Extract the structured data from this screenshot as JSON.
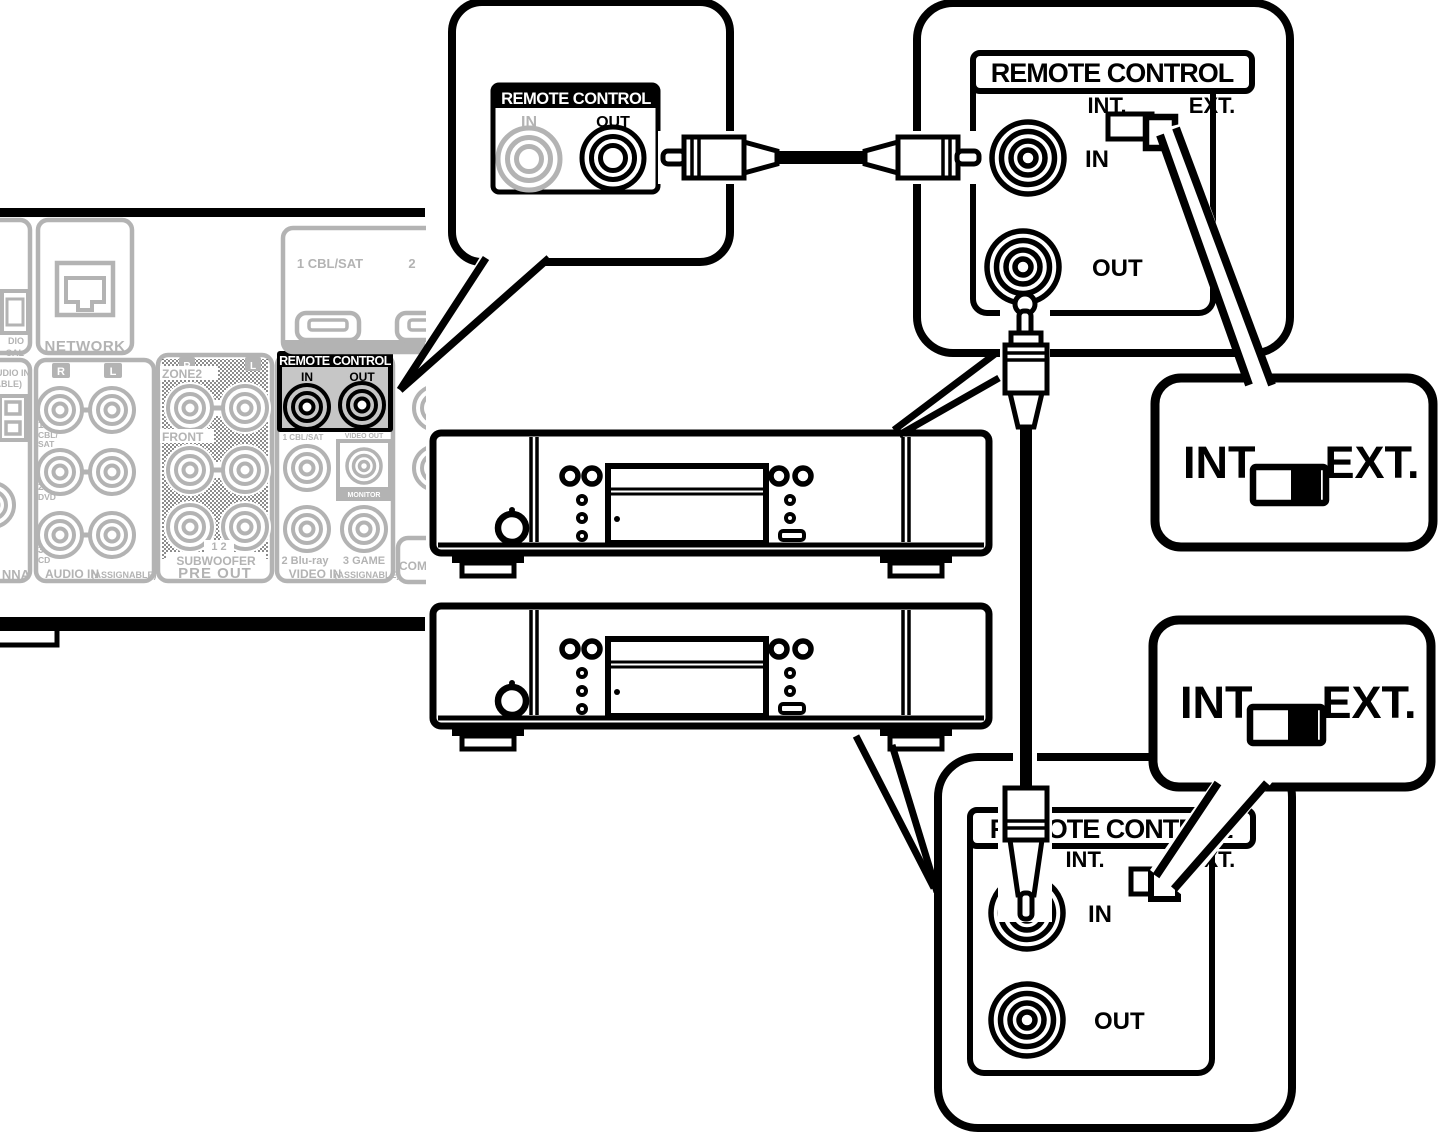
{
  "colors": {
    "line": "#000000",
    "receiver_gray": "#b3b3b3",
    "remote_section_bg": "#c6c6c6",
    "white": "#ffffff"
  },
  "receiver": {
    "network": "NETWORK",
    "optical_partial1": "DIO",
    "optical_partial2": "CAL",
    "audio_in_partial1": "UDIO IN",
    "audio_in_partial2": "ABLE)",
    "antenna_partial": "NNA",
    "component_partial": "COM",
    "audio_in": {
      "r": "R",
      "l": "L",
      "n1": "1",
      "n1b": "CBL/",
      "n1c": "SAT",
      "n2": "2",
      "n2b": "DVD",
      "n3": "3",
      "n3b": "CD",
      "label": "AUDIO IN",
      "label_sub": "(ASSIGNABLE)"
    },
    "pre_out": {
      "r": "R",
      "l": "L",
      "zone2": "ZONE2",
      "front": "FRONT",
      "nums": "1 2",
      "subwoofer": "SUBWOOFER",
      "label": "PRE OUT"
    },
    "remote": {
      "title": "REMOTE CONTROL",
      "in": "IN",
      "out": "OUT"
    },
    "video_in": {
      "row1": "1 CBL/SAT",
      "video_out": "VIDEO OUT",
      "monitor": "MONITOR",
      "row2a": "2 Blu-ray",
      "row2b": "3 GAME",
      "label": "VIDEO IN",
      "label_sub": "(ASSIGNABLE)"
    },
    "hdmi": {
      "cbl": "1 CBL/SAT",
      "two": "2"
    }
  },
  "jack_callout": {
    "title": "REMOTE CONTROL",
    "in": "IN",
    "out": "OUT"
  },
  "panel_top": {
    "title": "REMOTE CONTROL",
    "int": "INT.",
    "ext": "EXT.",
    "in": "IN",
    "out": "OUT"
  },
  "panel_bottom": {
    "title": "REMOTE CONTROL",
    "int": "INT.",
    "ext": "EXT.",
    "in": "IN",
    "out": "OUT"
  },
  "switch_callout_top": {
    "int": "INT.",
    "ext": "EXT."
  },
  "switch_callout_bottom": {
    "int": "INT.",
    "ext": "EXT."
  }
}
